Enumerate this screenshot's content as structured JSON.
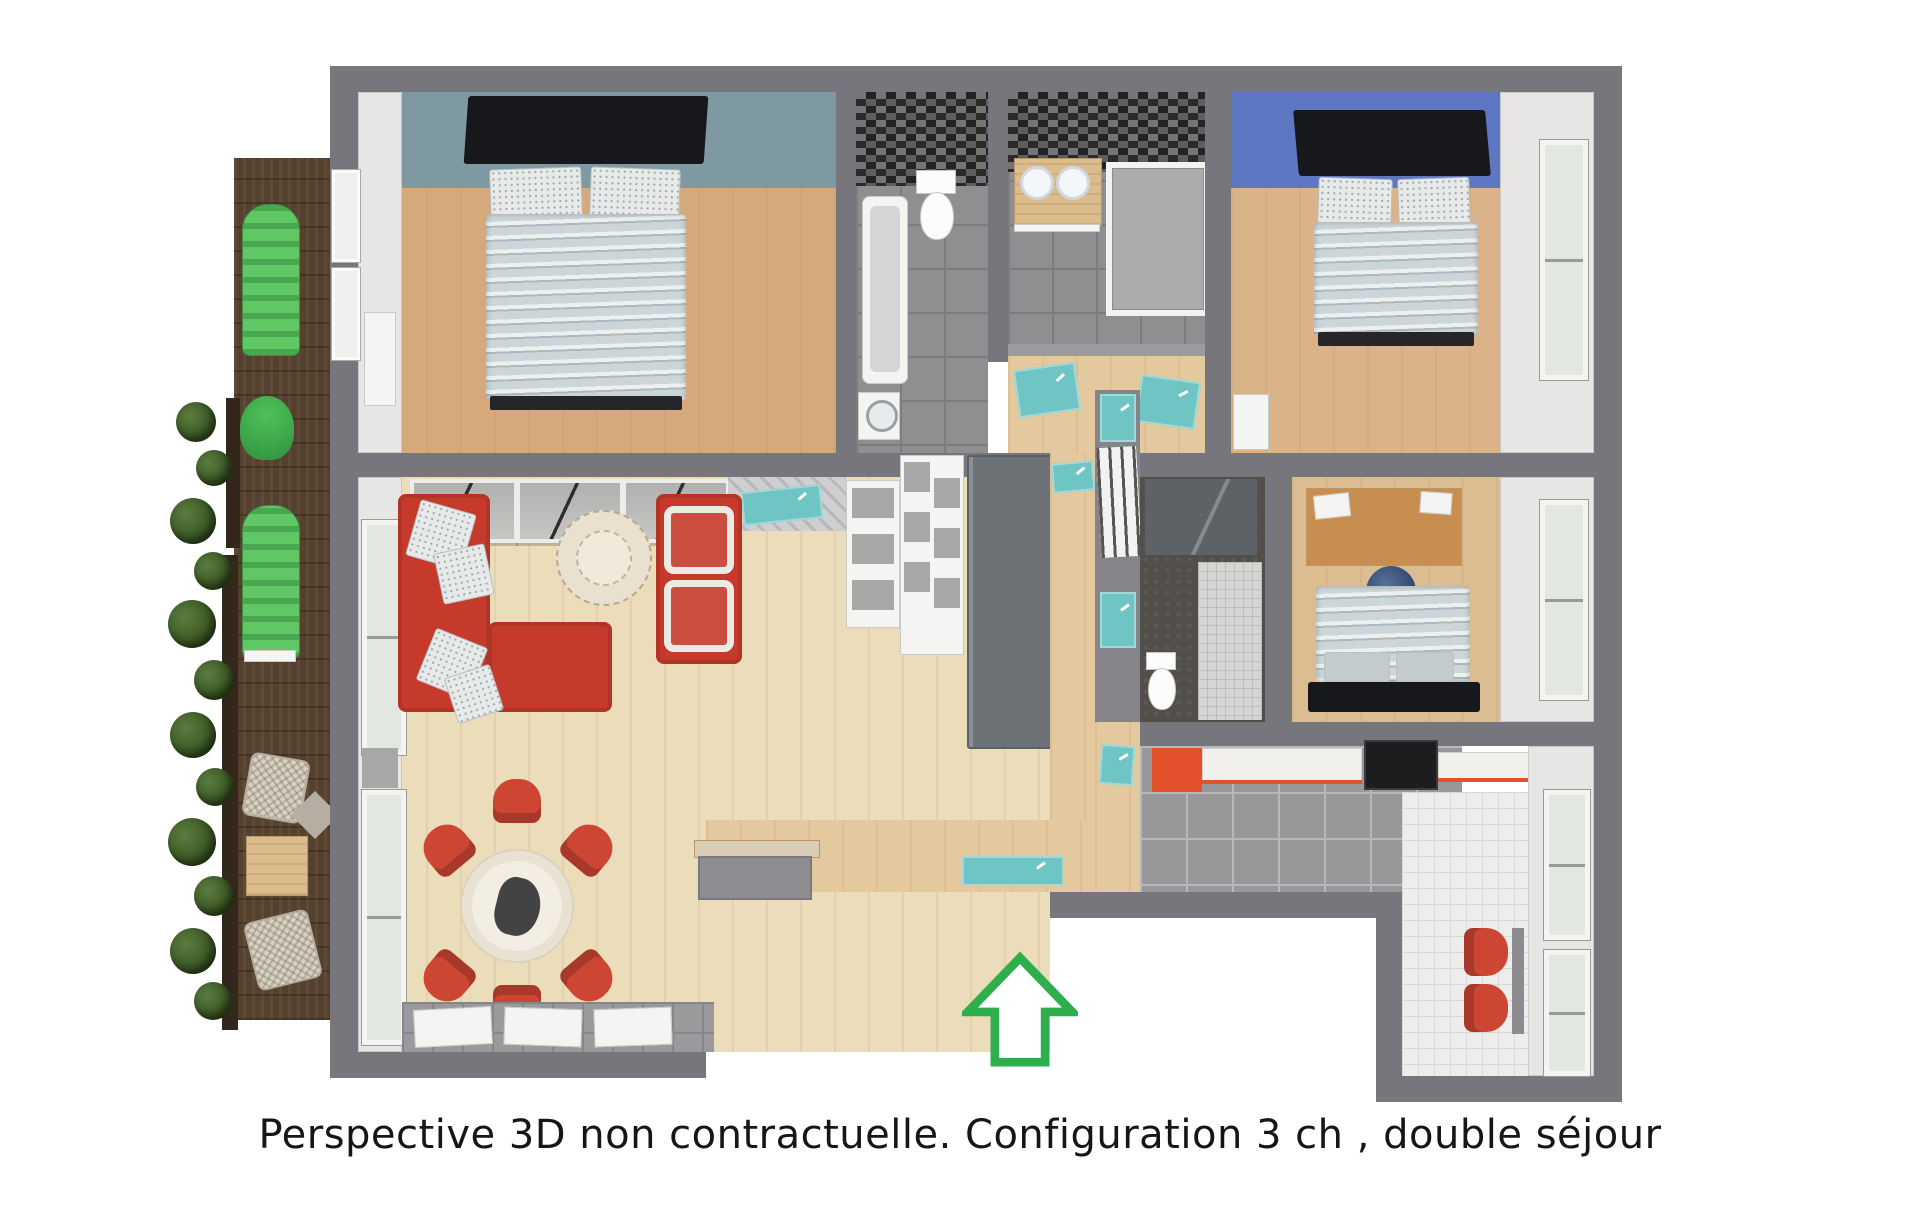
{
  "caption": {
    "text": "Perspective 3D non contractuelle. Configuration 3 ch , double séjour"
  },
  "entrance_arrow": {
    "meaning": "entrance-direction-indicator",
    "color": "#2fae4d"
  },
  "palette": {
    "canvas-bg": "#ffffff",
    "wall": "#77767c",
    "wall-inner": "#e7e6e4",
    "bed1-wall": "#7e99a2",
    "bed2-wall": "#5d77c3",
    "floor-bed1": "#d5a97c",
    "floor-bed2": "#dab388",
    "floor-bed3": "#dcbd92",
    "floor-living": "#ebdcba",
    "floor-hall": "#e4c99e",
    "tile-bath": "#8f8f91",
    "mosaic-dark": "#232323",
    "mosaic-mid": "#5e5e5e",
    "teal": "#6fc5c3",
    "sofa-red": "#c63a2c",
    "chair-red": "#cd4533",
    "kitchen-orange": "#e2512b",
    "arrow-green": "#2fae4d",
    "deck-brown": "#55412e",
    "lounger-green": "#5fc763",
    "plant-green": "#35511f",
    "wicker-beige": "#d8d1c3",
    "kitchen-floor": "#98989b",
    "nook-floor": "#ededeb",
    "unit-gray": "#6d7277",
    "duvet-light": "#ccd5d7",
    "canopy-black": "#17181b"
  }
}
